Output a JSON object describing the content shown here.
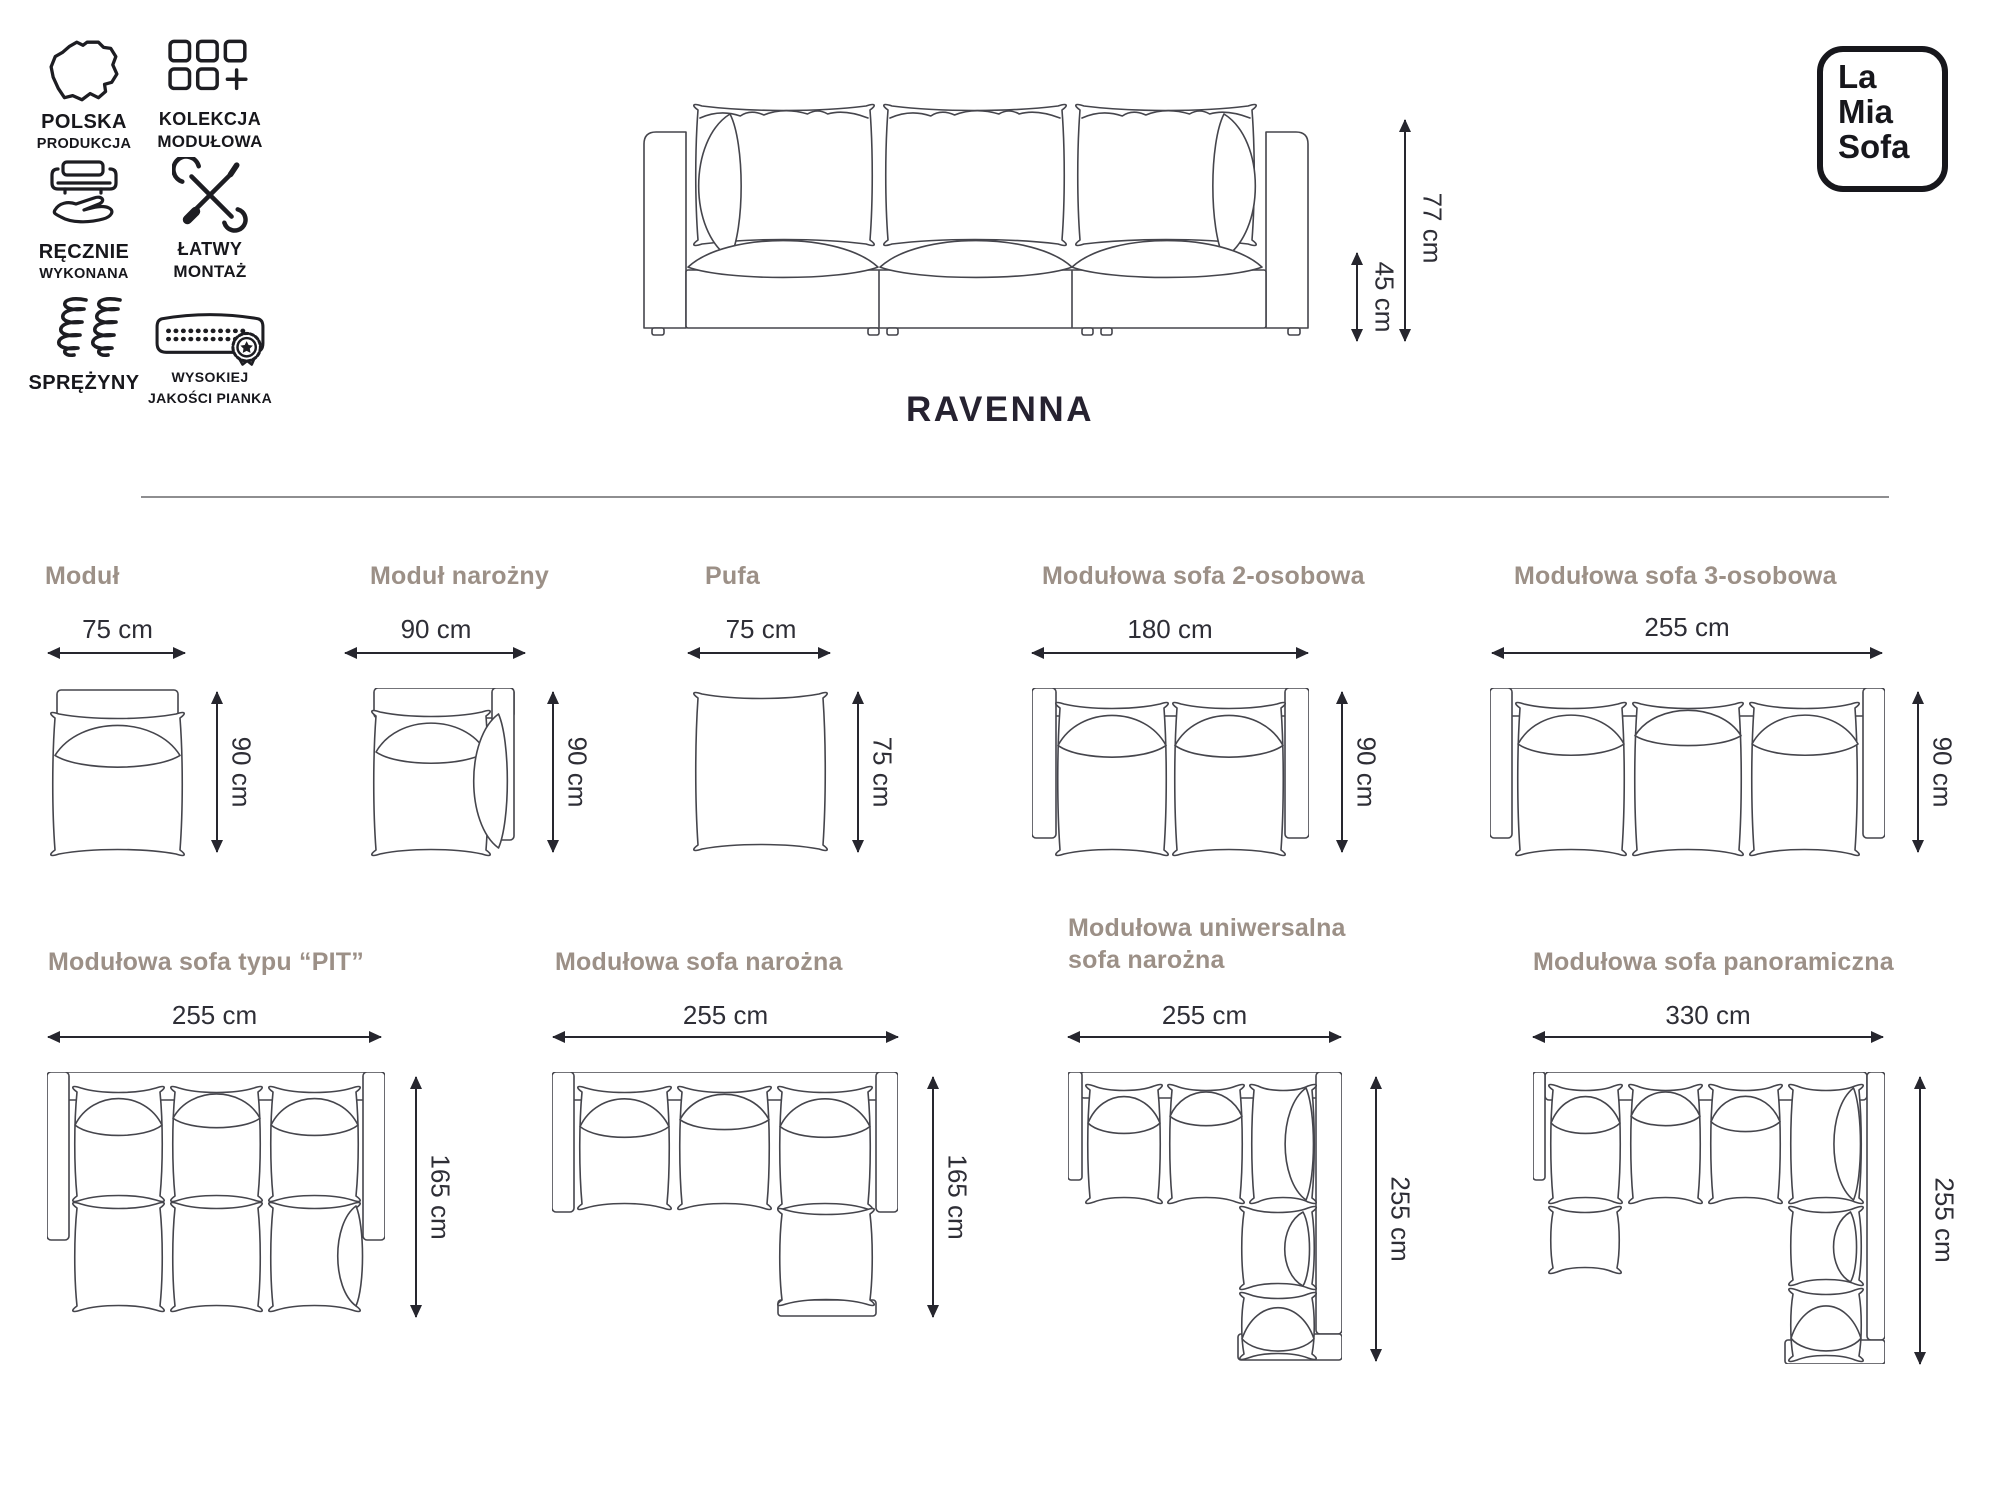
{
  "header": {
    "product_name": "RAVENNA",
    "dimensions": {
      "total_height": "77 cm",
      "seat_height": "45 cm"
    },
    "logo_lines": [
      "La",
      "Mia",
      "Sofa"
    ]
  },
  "features": [
    {
      "icon": "poland-map-icon",
      "line1": "POLSKA",
      "line2": "PRODUKCJA"
    },
    {
      "icon": "modules-grid-icon",
      "line1": "KOLEKCJA",
      "line2": "MODUŁOWA"
    },
    {
      "icon": "handmade-icon",
      "line1": "RĘCZNIE",
      "line2": "WYKONANA"
    },
    {
      "icon": "tools-icon",
      "line1": "ŁATWY",
      "line2": "MONTAŻ"
    },
    {
      "icon": "springs-icon",
      "line1": "SPRĘŻYNY",
      "line2": ""
    },
    {
      "icon": "foam-quality-icon",
      "line1": "WYSOKIEJ",
      "line2": "JAKOŚCI PIANKA"
    }
  ],
  "modules": [
    {
      "title": "Moduł",
      "width_label": "75 cm",
      "height_label": "90 cm"
    },
    {
      "title": "Moduł narożny",
      "width_label": "90 cm",
      "height_label": "90 cm"
    },
    {
      "title": "Pufa",
      "width_label": "75 cm",
      "height_label": "75 cm"
    },
    {
      "title": "Modułowa sofa 2-osobowa",
      "width_label": "180 cm",
      "height_label": "90 cm"
    },
    {
      "title": "Modułowa sofa 3-osobowa",
      "width_label": "255 cm",
      "height_label": "90 cm"
    },
    {
      "title": "Modułowa sofa typu “PIT”",
      "width_label": "255 cm",
      "height_label": "165 cm"
    },
    {
      "title": "Modułowa sofa narożna",
      "width_label": "255 cm",
      "height_label": "165 cm"
    },
    {
      "title": "Modułowa uniwersalna sofa narożna",
      "title_lines": [
        "Modułowa uniwersalna",
        "sofa narożna"
      ],
      "width_label": "255 cm",
      "height_label": "255 cm"
    },
    {
      "title": "Modułowa sofa panoramiczna",
      "width_label": "330 cm",
      "height_label": "255 cm"
    }
  ]
}
